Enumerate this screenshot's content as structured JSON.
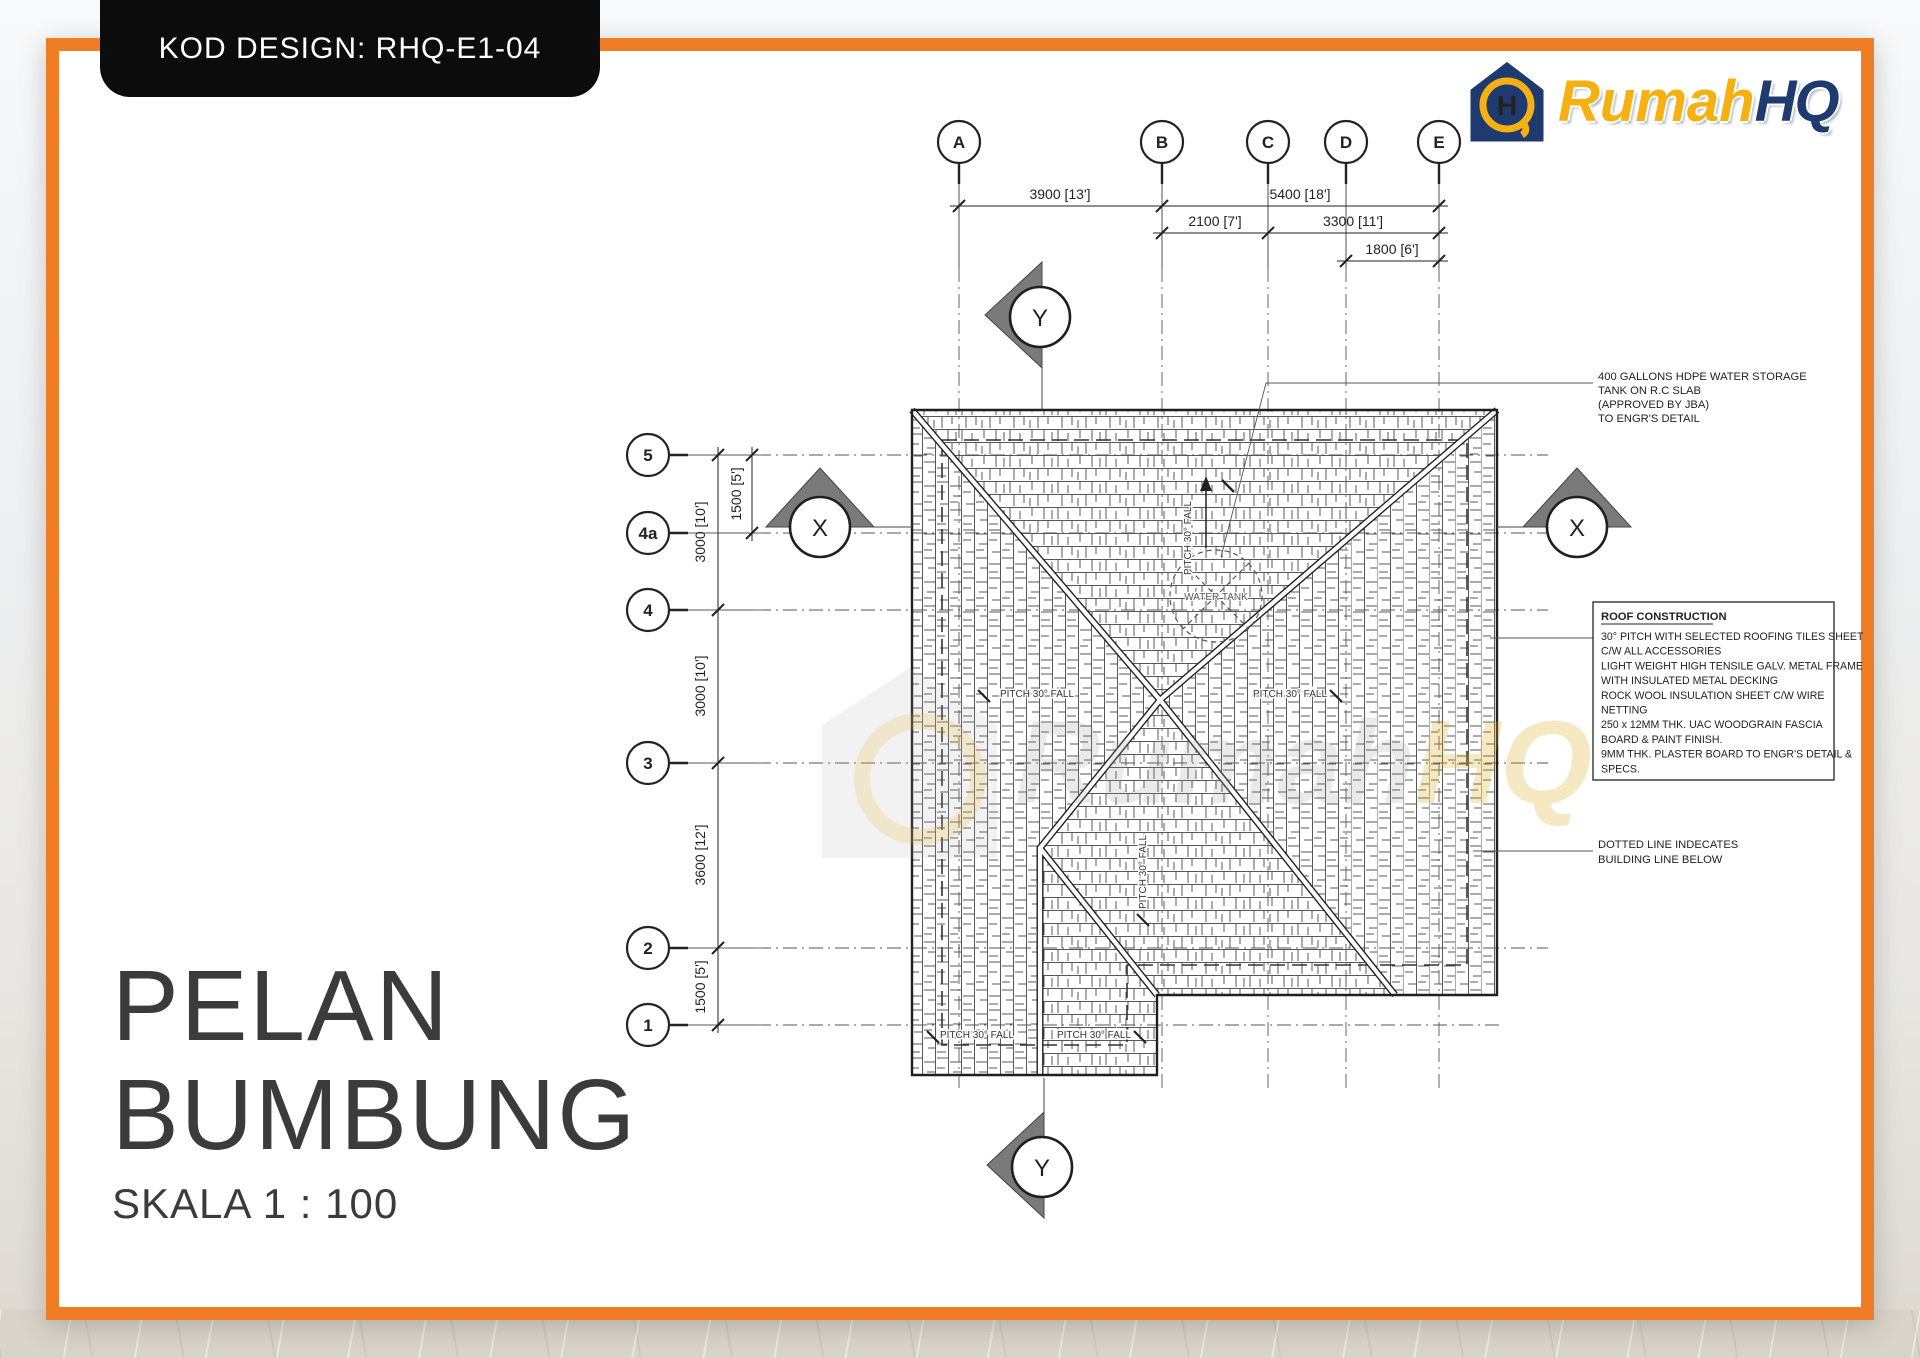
{
  "badge": {
    "label": "KOD DESIGN: RHQ-E1-04"
  },
  "logo": {
    "brand_part1": "Rumah",
    "brand_part2": "HQ",
    "icon": "house-h-monogram"
  },
  "title_block": {
    "line1": "PELAN",
    "line2": "BUMBUNG",
    "scale": "SKALA 1 : 100"
  },
  "grid": {
    "columns": [
      "A",
      "B",
      "C",
      "D",
      "E"
    ],
    "rows": [
      "5",
      "4a",
      "4",
      "3",
      "2",
      "1"
    ]
  },
  "dimensions": {
    "top": [
      "3900 [13']",
      "5400 [18']",
      "2100 [7']",
      "3300 [11']",
      "1800 [6']"
    ],
    "left": [
      "1500 [5']",
      "3000 [10']",
      "3000 [10']",
      "3600 [12']",
      "1500 [5']"
    ]
  },
  "sections": {
    "x": "X",
    "y": "Y"
  },
  "plan": {
    "pitch_fall": "PITCH 30° FALL",
    "water_tank": "WATER TANK"
  },
  "notes": {
    "water_tank": {
      "lines": [
        "400 GALLONS HDPE WATER STORAGE",
        "TANK ON R.C SLAB",
        "(APPROVED BY JBA)",
        "TO ENGR'S DETAIL"
      ]
    },
    "roof_construction": {
      "title": "ROOF CONSTRUCTION",
      "lines": [
        "30° PITCH WITH SELECTED ROOFING TILES SHEET",
        "C/W ALL ACCESSORIES",
        "LIGHT WEIGHT HIGH TENSILE GALV. METAL FRAME",
        "WITH INSULATED METAL DECKING",
        "ROCK WOOL INSULATION SHEET C/W WIRE",
        "NETTING",
        "250 x 12MM THK. UAC WOODGRAIN FASCIA",
        "BOARD & PAINT FINISH.",
        "9MM THK. PLASTER BOARD TO ENGR'S DETAIL &",
        "SPECS."
      ]
    },
    "dotted_line": {
      "lines": [
        "DOTTED LINE INDECATES",
        "BUILDING LINE BELOW"
      ]
    }
  },
  "watermark": {
    "part1": "Rumah",
    "part2": "HQ"
  },
  "colors": {
    "frame_orange": "#F07C24",
    "badge_black": "#0C0C0C",
    "logo_navy": "#1E3A6E",
    "logo_gold": "#F5B011",
    "section_marker_gray": "#7A7A7A"
  }
}
